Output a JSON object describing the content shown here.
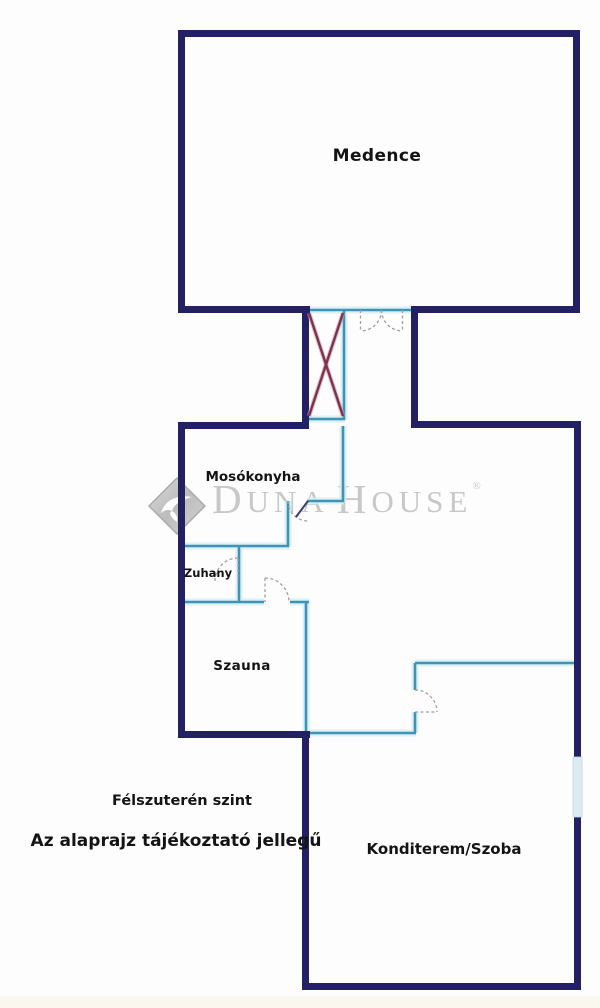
{
  "rooms": {
    "medence": "Medence",
    "mosokonyha": "Mosókonyha",
    "zuhany": "Zuhany",
    "szauna": "Szauna",
    "konditerem": "Konditerem/Szoba"
  },
  "annotations": {
    "floor_level": "Félszuterén szint",
    "disclaimer": "Az alaprajz tájékoztató jellegű"
  },
  "watermark": {
    "d": "D",
    "una": "UNA",
    "h": "H",
    "ouse": "OUSE",
    "registered": "®"
  },
  "colors": {
    "outer_wall": "#232063",
    "partition_wall": "#3d94b5",
    "partition_glow": "#d6edf5",
    "stairs_cross": "#7c3350",
    "window": "#dcebf2",
    "door_swing": "#a0a0a0",
    "label_text": "#141414",
    "watermark_gray": "#c8c8c8",
    "background": "#fdfdfd"
  }
}
